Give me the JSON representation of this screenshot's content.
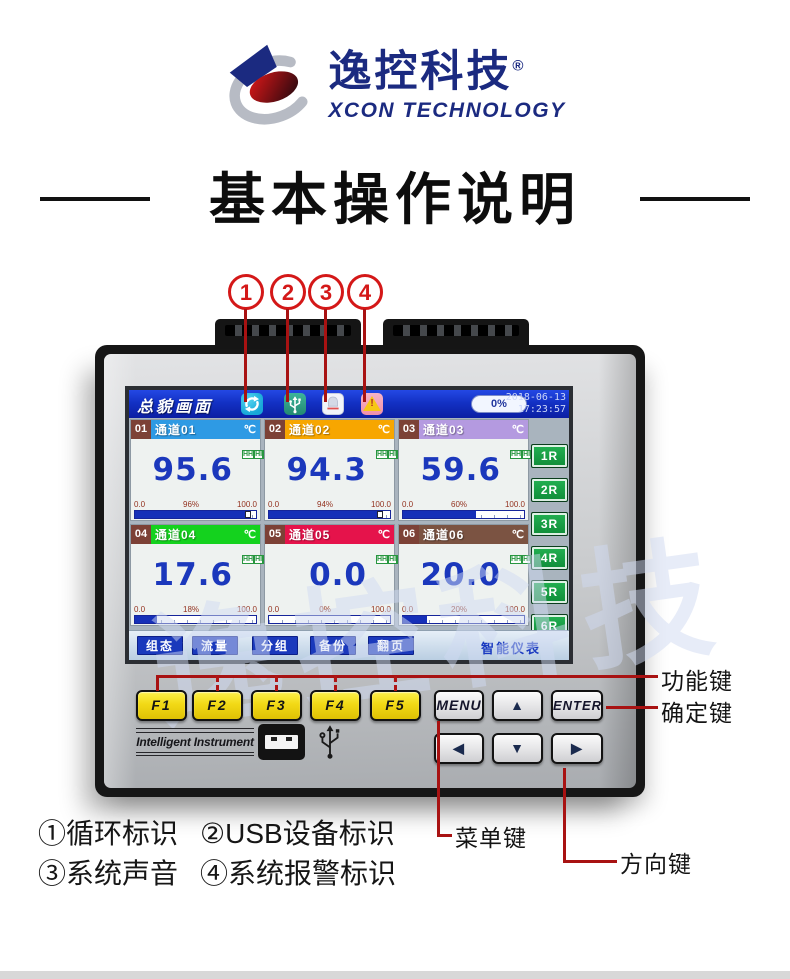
{
  "brand": {
    "logo_cn": "逸控科技",
    "reg_mark": "®",
    "logo_en": "XCON TECHNOLOGY"
  },
  "page": {
    "title": "基本操作说明"
  },
  "callouts": [
    "1",
    "2",
    "3",
    "4"
  ],
  "screen": {
    "view_title": "总貌画面",
    "icons": [
      "cycle",
      "usb-device",
      "system-sound",
      "system-alarm"
    ],
    "progress": "0%",
    "date": "2018-06-13",
    "time": "17:23:57",
    "alarm_levels": [
      "HH",
      "HI",
      "LO",
      "LL"
    ],
    "channels": [
      {
        "no": "01",
        "name": "通道01",
        "unit": "℃",
        "value": "95.6",
        "min": "0.0",
        "pct_label": "96%",
        "max": "100.0",
        "pct": 96,
        "header_color": "#2e9ae4"
      },
      {
        "no": "02",
        "name": "通道02",
        "unit": "℃",
        "value": "94.3",
        "min": "0.0",
        "pct_label": "94%",
        "max": "100.0",
        "pct": 94,
        "header_color": "#f7a600"
      },
      {
        "no": "03",
        "name": "通道03",
        "unit": "℃",
        "value": "59.6",
        "min": "0.0",
        "pct_label": "60%",
        "max": "100.0",
        "pct": 60,
        "header_color": "#b49ae0"
      },
      {
        "no": "04",
        "name": "通道04",
        "unit": "℃",
        "value": "17.6",
        "min": "0.0",
        "pct_label": "18%",
        "max": "100.0",
        "pct": 18,
        "header_color": "#14d21e"
      },
      {
        "no": "05",
        "name": "通道05",
        "unit": "℃",
        "value": "0.0",
        "min": "0.0",
        "pct_label": "0%",
        "max": "100.0",
        "pct": 0,
        "header_color": "#e5134b"
      },
      {
        "no": "06",
        "name": "通道06",
        "unit": "℃",
        "value": "20.0",
        "min": "0.0",
        "pct_label": "20%",
        "max": "100.0",
        "pct": 20,
        "header_color": "#7b5342"
      }
    ],
    "r_buttons": [
      "1R",
      "2R",
      "3R",
      "4R",
      "5R",
      "6R"
    ],
    "menu_buttons": [
      "组态",
      "流量",
      "分组",
      "备份",
      "翻页"
    ],
    "brand_label": "智能仪表",
    "watermark": "逸控科技"
  },
  "keys": {
    "function": [
      "F1",
      "F2",
      "F3",
      "F4",
      "F5"
    ],
    "menu": "MENU",
    "enter": "ENTER",
    "up": "▲",
    "down": "▼",
    "left": "◀",
    "right": "▶"
  },
  "panel": {
    "label": "Intelligent  Instrument"
  },
  "annotations": {
    "function_keys": "功能键",
    "enter_key": "确定键",
    "menu_key": "菜单键",
    "direction_keys": "方向键",
    "legend_1": "①循环标识",
    "legend_2": "②USB设备标识",
    "legend_3": "③系统声音",
    "legend_4": "④系统报警标识"
  },
  "colors": {
    "accent_red": "#d41818",
    "annotation_red": "#a81212",
    "brand_navy": "#1b2a80",
    "screen_blue": "#1331c4",
    "value_blue": "#1b38bc",
    "key_yellow": "#f2d916",
    "relay_green": "#159a3d"
  }
}
